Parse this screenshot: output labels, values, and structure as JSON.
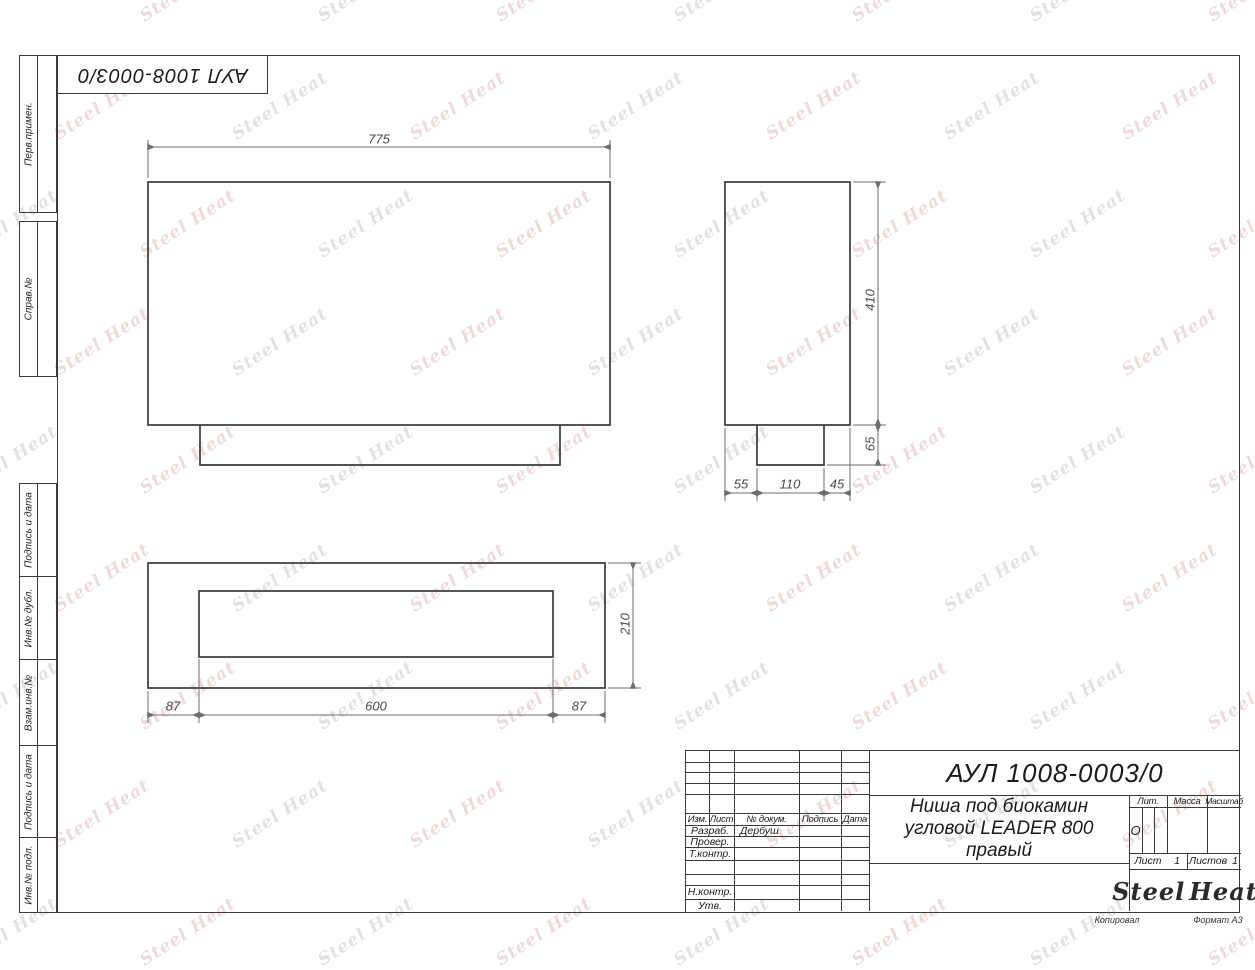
{
  "top_box": {
    "designation": "АУЛ 1008-0003/0"
  },
  "left_margin": {
    "labels": [
      "Перв.примен.",
      "Справ.№",
      "Подпись и дата",
      "Инв.№ дубл.",
      "Взам.инв.№",
      "Подпись и дата",
      "Инв.№ подл."
    ]
  },
  "views": {
    "front": {
      "width": "775"
    },
    "side": {
      "height": "410",
      "base_height": "65",
      "seg_left": "55",
      "seg_mid": "110",
      "seg_right": "45"
    },
    "plan": {
      "depth": "210",
      "seg_left": "87",
      "seg_mid": "600",
      "seg_right": "87"
    }
  },
  "title_block": {
    "designation": "АУЛ 1008-0003/0",
    "name_line1": "Ниша под биокамин",
    "name_line2": "угловой LEADER 800",
    "name_line3": "правый",
    "columns": {
      "izm": "Изм.",
      "list": "Лист",
      "doc": "№ докум.",
      "sign": "Подпись",
      "date": "Дата"
    },
    "rows": {
      "razrab": "Разраб.",
      "prover": "Провер.",
      "tkontr": "Т.контр.",
      "nkontr": "Н.контр.",
      "utv": "Утв."
    },
    "razrab_name": "Дербуш",
    "lit_label": "Лит.",
    "lit_value": "О",
    "massa_label": "Масса",
    "masshtab_label": "Масштаб",
    "list_label": "Лист",
    "list_value": "1",
    "listov_label": "Листов",
    "listov_value": "1",
    "logo": {
      "steel": "Steel",
      "heat": "Heat"
    },
    "footer": {
      "kopiroval": "Копировал",
      "format": "Формат А3"
    }
  },
  "watermark": {
    "text": "Steel Heat",
    "pink": "#c98f8f",
    "gray": "#9fae9f"
  },
  "colors": {
    "brand_red": "#e32119",
    "line": "#3a3a3a"
  }
}
